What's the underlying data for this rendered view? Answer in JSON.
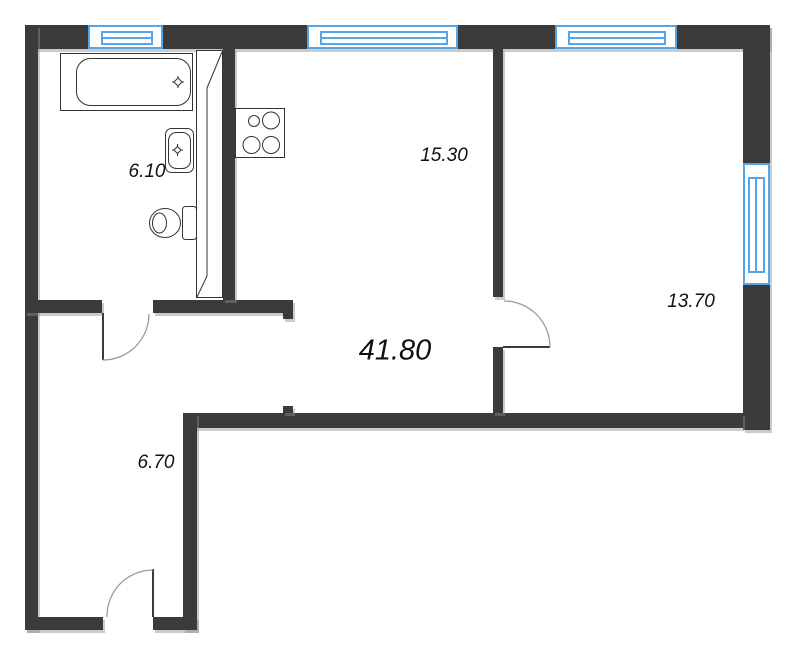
{
  "floor_plan": {
    "total_area": "41.80",
    "rooms": {
      "bathroom": {
        "area": "6.10"
      },
      "kitchen_living": {
        "area": "15.30"
      },
      "bedroom": {
        "area": "13.70"
      },
      "hallway": {
        "area": "6.70"
      }
    },
    "colors": {
      "wall": "#3b3b3b",
      "window": "#56a5e8",
      "door_arc": "#9a9a9a",
      "fixture_outline": "#333333",
      "label_text": "#111111"
    },
    "symbols": {
      "fixtures": [
        "bathtub",
        "sink",
        "toilet",
        "stove"
      ],
      "doors": [
        "bathroom-door",
        "entrance-door",
        "bedroom-door"
      ],
      "windows": [
        "top-window-1",
        "top-window-2",
        "top-window-3",
        "right-window"
      ]
    }
  }
}
